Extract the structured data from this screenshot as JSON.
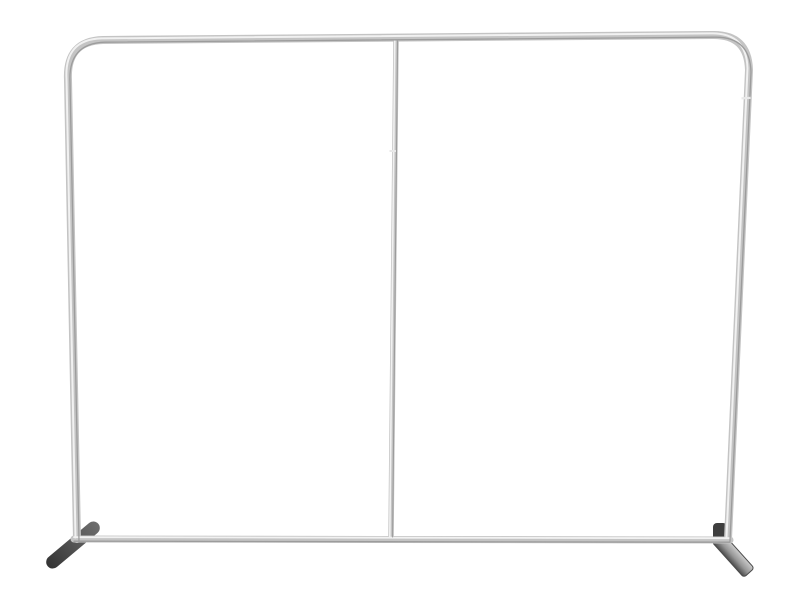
{
  "image": {
    "subject": "Empty tension-fabric display backdrop frame",
    "description": "Silver aluminum tube frame with rounded top corners, a thin center support pole, a bottom crossbar and two angled dark stabilizer feet, photographed on a plain white background",
    "background_color": "#ffffff"
  },
  "frame": {
    "tube_color": "#c4c4c4",
    "tube_highlight": "#f1f1f1",
    "tube_shadow": "#9c9c9c",
    "seam_color": "#e9e9e9"
  },
  "feet": {
    "left_foot_tip_color": "#343434",
    "left_foot_body_color": "#6e6e6e",
    "right_plate_top_color": "#cccccc",
    "right_plate_mid_color": "#969696",
    "right_plate_edge_color": "#4a4a4a",
    "connector_color": "#3e3e3e"
  }
}
